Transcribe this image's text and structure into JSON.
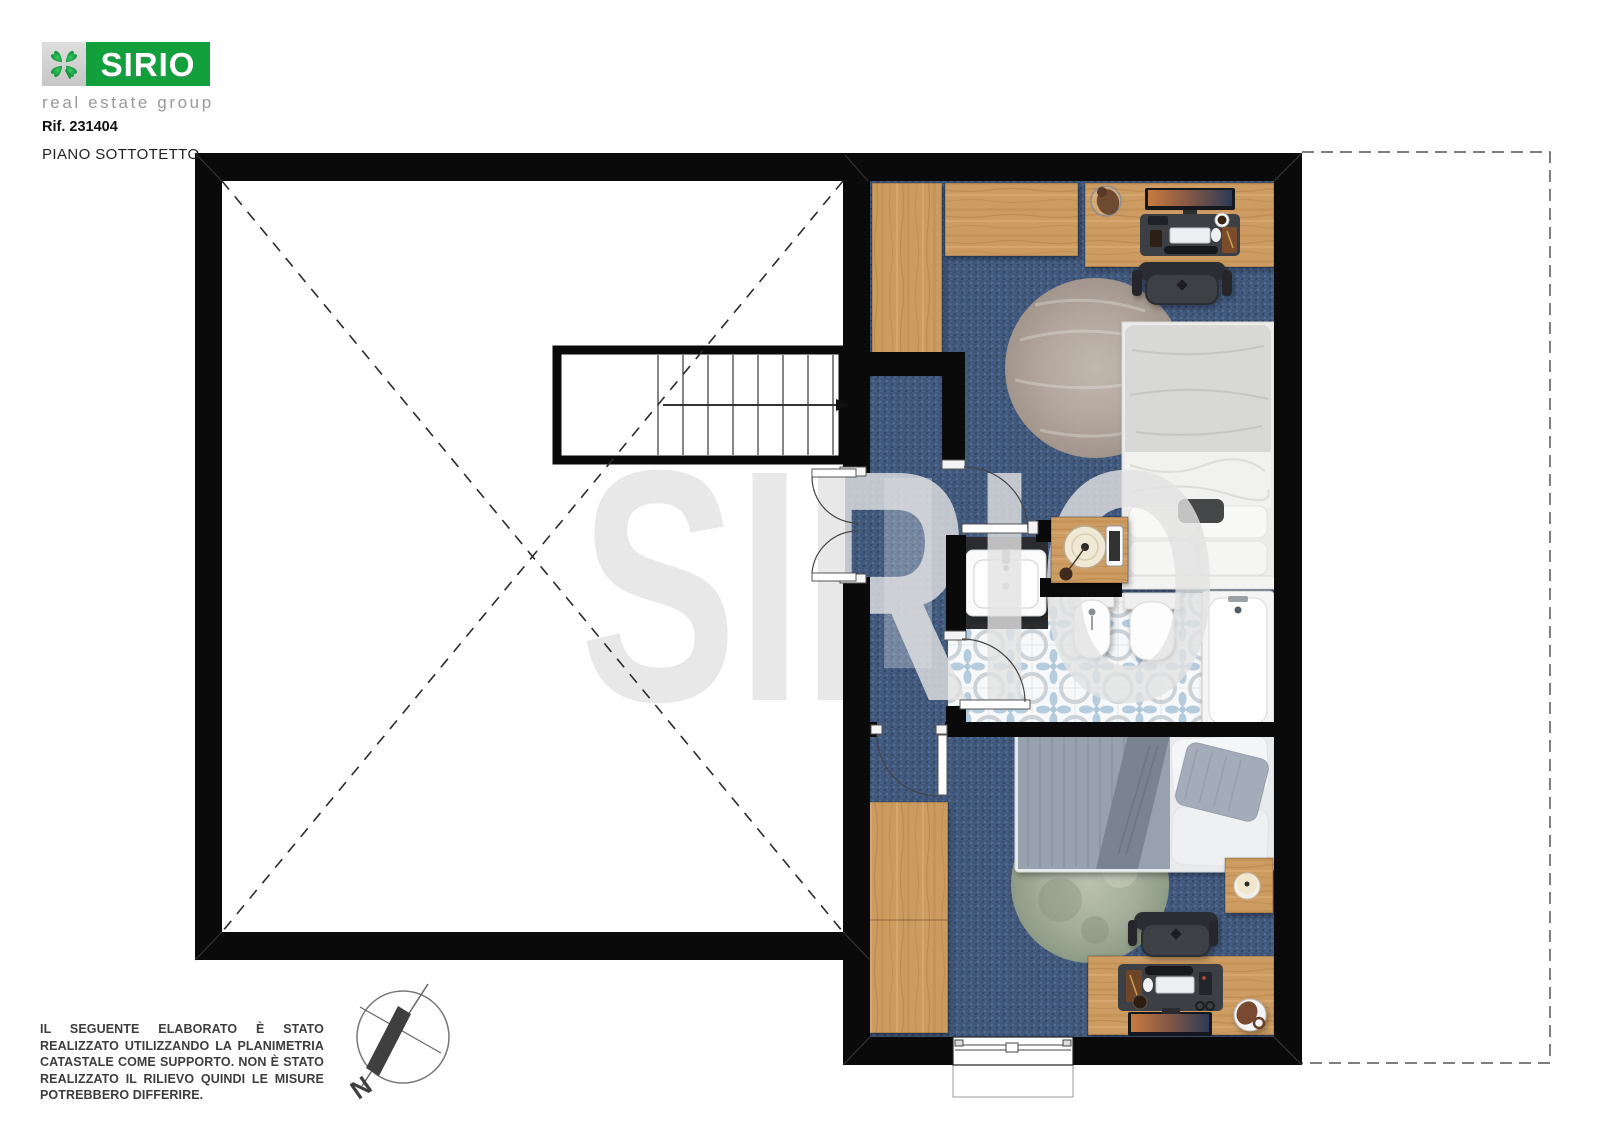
{
  "header": {
    "logo": {
      "name": "SIRIO",
      "tagline": "real estate group"
    },
    "reference": "Rif. 231404",
    "floor_label": "PIANO SOTTOTETTO"
  },
  "watermark": "SIRIO",
  "compass": {
    "north_label": "N"
  },
  "disclaimer": "IL SEGUENTE ELABORATO È STATO REALIZZATO UTILIZZANDO LA PLANIMETRIA CATASTALE COME SUPPORTO. NON È STATO REALIZZATO IL RILIEVO QUINDI LE MISURE POTREBBERO DIFFERIRE.",
  "icons": {
    "logo_icon": "clover-icon",
    "compass_icon": "compass-rose-icon"
  },
  "colors": {
    "logo_green": "#11a03c",
    "logo_gray": "#cfcfcf",
    "wall_black": "#0a0a0a",
    "carpet_blue": "#42597c",
    "wood": "#cc9c62",
    "tile_accent": "#a9c3da",
    "rug_taupe": "#b3a79d",
    "rug_sage": "#a7b09d",
    "watermark_gray": "#e3e3e3"
  }
}
